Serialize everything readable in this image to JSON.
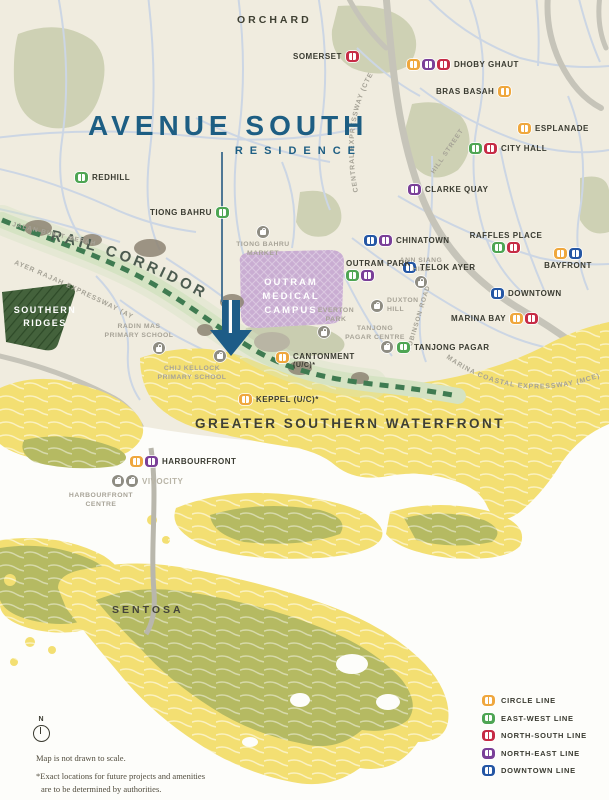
{
  "title": {
    "main": "AVENUE SOUTH",
    "sub": "RESIDENCE"
  },
  "areas": {
    "orchard": "ORCHARD",
    "rail_corridor": "RAIL CORRIDOR",
    "southern_ridges_1": "SOUTHERN",
    "southern_ridges_2": "RIDGES",
    "outram_1": "OUTRAM",
    "outram_2": "MEDICAL",
    "outram_3": "CAMPUS",
    "gsw": "GREATER SOUTHERN WATERFRONT",
    "sentosa": "SENTOSA"
  },
  "roads": {
    "cte": "CENTRAL EXPRESSWAY (CTE)",
    "aye": "AYER RAJAH EXPRESSWAY (AYE)",
    "mce": "MARINA COASTAL EXPRESSWAY (MCE)",
    "jbm": "JALAN BUKIT MERAH",
    "robinson": "ROBINSON ROAD",
    "hill": "HILL STREET"
  },
  "stations": {
    "somerset": {
      "label": "SOMERSET"
    },
    "dhoby_ghaut": {
      "label": "DHOBY GHAUT"
    },
    "bras_basah": {
      "label": "BRAS BASAH"
    },
    "esplanade": {
      "label": "ESPLANADE"
    },
    "city_hall": {
      "label": "CITY HALL"
    },
    "clarke_quay": {
      "label": "CLARKE QUAY"
    },
    "redhill": {
      "label": "REDHILL"
    },
    "tiong_bahru": {
      "label": "TIONG BAHRU"
    },
    "chinatown": {
      "label": "CHINATOWN"
    },
    "raffles_place": {
      "label": "RAFFLES PLACE"
    },
    "telok_ayer": {
      "label": "TELOK AYER"
    },
    "bayfront": {
      "label": "BAYFRONT"
    },
    "outram_park": {
      "label": "OUTRAM PARK"
    },
    "downtown": {
      "label": "DOWNTOWN"
    },
    "marina_bay": {
      "label": "MARINA BAY"
    },
    "tanjong_pagar": {
      "label": "TANJONG PAGAR"
    },
    "cantonment": {
      "label": "CANTONMENT",
      "note": "(U/C)*"
    },
    "keppel": {
      "label": "KEPPEL (U/C)*"
    },
    "harbourfront": {
      "label": "HARBOURFRONT"
    },
    "vivocity": {
      "label": "VIVOCITY"
    }
  },
  "places": {
    "tbm1": "TIONG BAHRU",
    "tbm2": "MARKET",
    "ann1": "ANN SIANG",
    "ann2": "HILL",
    "dux1": "DUXTON",
    "dux2": "HILL",
    "eve1": "EVERTON",
    "eve2": "PARK",
    "tpc1": "TANJONG",
    "tpc2": "PAGAR CENTRE",
    "rm1": "RADIN MAS",
    "rm2": "PRIMARY SCHOOL",
    "ck1": "CHIJ KELLOCK",
    "ck2": "PRIMARY SCHOOL",
    "hfc1": "HARBOURFRONT",
    "hfc2": "CENTRE"
  },
  "legend": {
    "items": [
      {
        "label": "CIRCLE LINE",
        "color": "#EFA73D"
      },
      {
        "label": "EAST-WEST LINE",
        "color": "#4EA553"
      },
      {
        "label": "NORTH-SOUTH LINE",
        "color": "#C62B45"
      },
      {
        "label": "NORTH-EAST LINE",
        "color": "#7A3F98"
      },
      {
        "label": "DOWNTOWN LINE",
        "color": "#2456A4"
      }
    ]
  },
  "footer": {
    "compass": "N",
    "note1": "Map is not drawn to scale.",
    "note2": "*Exact locations for future projects and amenities",
    "note3": "are to be determined by authorities."
  },
  "colors": {
    "brand_blue": "#1D5E83",
    "waterfront_yellow": "#F3DF72",
    "hill_olive": "#B5BA62",
    "ridge_green": "#44623C",
    "medical_purple": "#C9ADD2",
    "corridor_dash_green": "#3F7B51"
  }
}
